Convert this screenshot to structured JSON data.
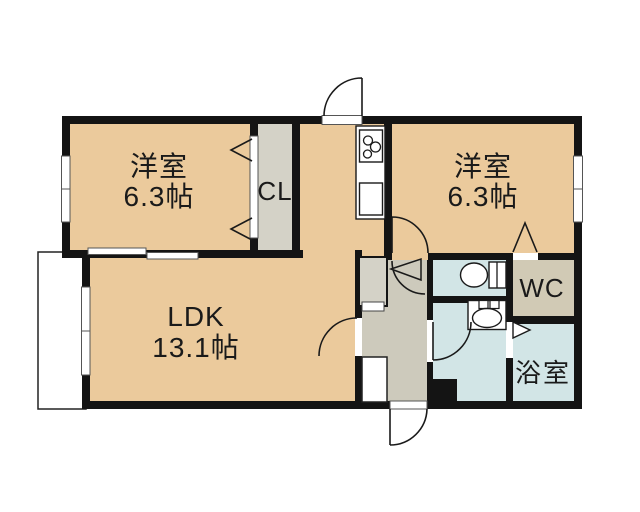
{
  "title": "間取り図",
  "colors": {
    "wall": "#141414",
    "room": "#EBCA9C",
    "hall": "#CDCABC",
    "closet": "#D4D2C7",
    "wcroom": "#D1CAB5",
    "wet": "#D2E5E6"
  },
  "rooms": {
    "western1": {
      "name": "洋室",
      "area": "6.3帖"
    },
    "western2": {
      "name": "洋室",
      "area": "6.3帖"
    },
    "ldk": {
      "name": "LDK",
      "area": "13.1帖"
    },
    "closet": {
      "name": "CL"
    },
    "wc": {
      "name": "WC"
    },
    "bath": {
      "name": "浴室"
    }
  },
  "fixtures": [
    "gas-stove-3-burner",
    "kitchen-sink",
    "toilet",
    "washbasin",
    "pipe-space",
    "balcony"
  ]
}
